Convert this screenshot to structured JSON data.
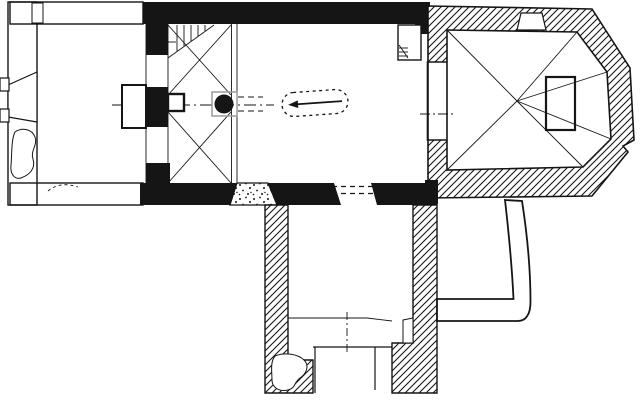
{
  "document": {
    "kind": "church-floor-plan",
    "style": "black-and-white line drawing, scanned plan, no text labels"
  },
  "colors": {
    "ink": "#151515",
    "background": "#ffffff",
    "plinth_gray": "#9a9a9a"
  },
  "patterns": [
    {
      "name": "stipple-fill",
      "applies_to": [
        "west-annex-walls",
        "nave-south-door"
      ]
    },
    {
      "name": "diagonal-hatch-fill",
      "applies_to": [
        "chancel-walls",
        "south-chapel-walls"
      ]
    },
    {
      "name": "solid-black-fill",
      "applies_to": [
        "nave-north-wall",
        "nave-south-wall",
        "tower-arcade-piers"
      ]
    },
    {
      "name": "outline-only",
      "applies_to": [
        "later-addition-band",
        "altar",
        "niche-rectangles"
      ]
    }
  ],
  "elements": [
    {
      "name": "west-annex",
      "desc": "western room with stippled walls and splayed west portal"
    },
    {
      "name": "west-portal",
      "desc": "funnel-shaped opening in west wall with projecting outer frame"
    },
    {
      "name": "masonry-blob",
      "desc": "irregular outlined patch inside stippled wall"
    },
    {
      "name": "tower-gallery",
      "desc": "two vaulted bays with X ribs, central pier and round column"
    },
    {
      "name": "spiral-stair",
      "desc": "winder stair in north-west corner of tower bay"
    },
    {
      "name": "round-column",
      "desc": "black circular pier on gray plinth between tower and nave"
    },
    {
      "name": "nave",
      "desc": "main hall with black walls"
    },
    {
      "name": "grave-slab-marker",
      "desc": "dashed oval with left-pointing arrow on nave floor"
    },
    {
      "name": "nave-south-door",
      "desc": "stippled splayed doorway in south wall"
    },
    {
      "name": "chancel-arch",
      "desc": "opening between nave and chancel with hatched jambs"
    },
    {
      "name": "corner-stair-niche",
      "desc": "small outlined rectangle with steps at nave NE corner"
    },
    {
      "name": "chancel-apse",
      "desc": "polygonal east end, hatched walls, radiating vault ribs"
    },
    {
      "name": "altar",
      "desc": "outlined rectangle in apse"
    },
    {
      "name": "north-wall-niche",
      "desc": "small splayed recess in chancel north wall"
    },
    {
      "name": "south-chapel",
      "desc": "hatched-wall chapel attached to nave south side"
    },
    {
      "name": "chapel-south-doorway",
      "desc": "door opening in chapel south wall"
    },
    {
      "name": "later-addition-band",
      "desc": "curved L-shaped structure drawn in outline only"
    },
    {
      "name": "axis-line",
      "desc": "dash-dot centre lines"
    }
  ]
}
